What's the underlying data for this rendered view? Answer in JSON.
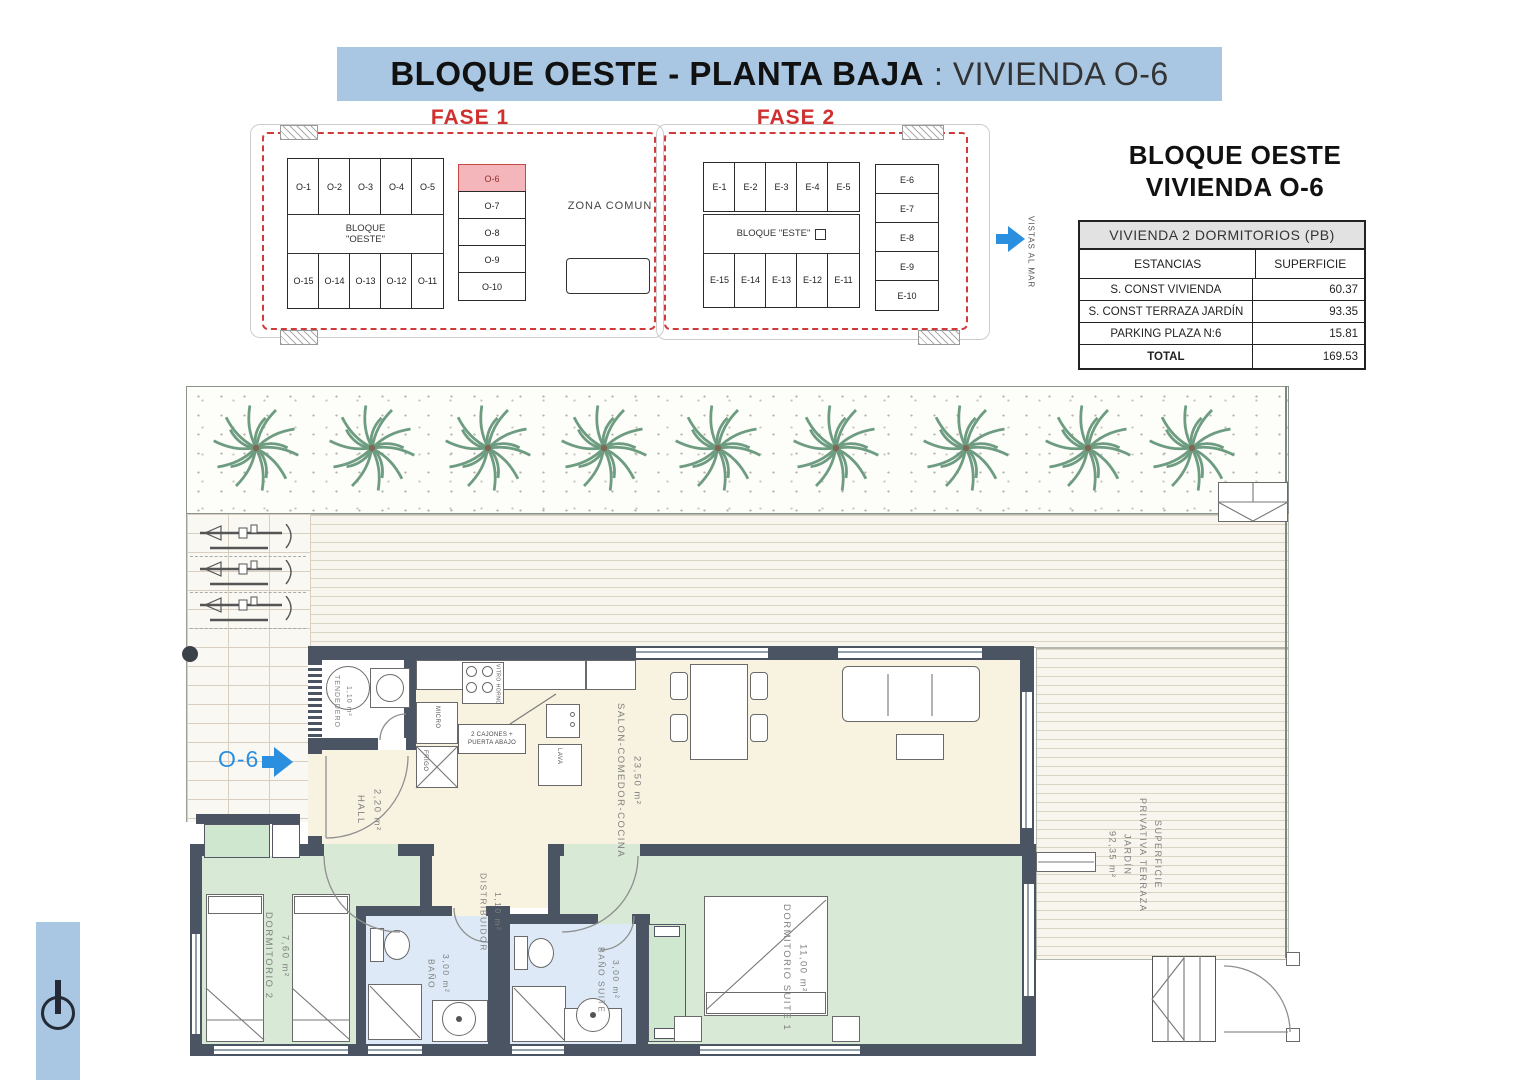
{
  "banner": {
    "title_bold": "BLOQUE OESTE - PLANTA BAJA",
    "title_rest": ": VIVIENDA O-6"
  },
  "site_plan": {
    "fase1": {
      "label": "FASE 1",
      "block_line1": "BLOQUE",
      "block_line2": "\"OESTE\"",
      "zona_comun": "ZONA COMUN",
      "top_units": [
        "O-1",
        "O-2",
        "O-3",
        "O-4",
        "O-5"
      ],
      "right_units": [
        "O-6",
        "O-7",
        "O-8",
        "O-9",
        "O-10"
      ],
      "bottom_units": [
        "O-15",
        "O-14",
        "O-13",
        "O-12",
        "O-11"
      ],
      "highlighted_unit": "O-6"
    },
    "fase2": {
      "label": "FASE 2",
      "block_label": "BLOQUE \"ESTE\"",
      "top_units": [
        "E-1",
        "E-2",
        "E-3",
        "E-4",
        "E-5"
      ],
      "right_units": [
        "E-6",
        "E-7",
        "E-8",
        "E-9",
        "E-10"
      ],
      "bottom_units": [
        "E-15",
        "E-14",
        "E-13",
        "E-12",
        "E-11"
      ]
    },
    "vistas_al_mar": "VISTAS AL MAR"
  },
  "info_panel": {
    "title_line1": "BLOQUE OESTE",
    "title_line2": "VIVIENDA O-6",
    "table": {
      "header": "VIVIENDA 2 DORMITORIOS (PB)",
      "col_estancias": "ESTANCIAS",
      "col_superficie": "SUPERFICIE",
      "rows": [
        {
          "estancia": "S. CONST VIVIENDA",
          "superficie": "60.37"
        },
        {
          "estancia": "S. CONST TERRAZA JARDÍN",
          "superficie": "93.35"
        },
        {
          "estancia": "PARKING   PLAZA   N:6",
          "superficie": "15.81"
        },
        {
          "estancia": "TOTAL",
          "superficie": "169.53"
        }
      ]
    }
  },
  "floor_plan": {
    "entry_label": "O-6",
    "rooms": {
      "tendedero": {
        "name": "TENDEDERO",
        "area": "1,10 m²"
      },
      "hall": {
        "name": "HALL",
        "area": "2,20 m²"
      },
      "salon": {
        "name": "SALON-COMEDOR-COCINA",
        "area": "23,50 m²"
      },
      "distribuidor": {
        "name": "DISTRIBUIDOR",
        "area": "1,10 m²"
      },
      "dormitorio2": {
        "name": "DORMITORIO 2",
        "area": "7,60 m²"
      },
      "bano": {
        "name": "BAÑO",
        "area": "3,00 m²"
      },
      "bano_suite": {
        "name": "BAÑO SUITE",
        "area": "3,00 m²"
      },
      "dormitorio_suite": {
        "name": "DORMITORIO SUITE 1",
        "area": "11,00 m²"
      }
    },
    "kitchen_labels": {
      "micro": "MICRO",
      "frigo": "FRIGO",
      "lava": "LAVA",
      "vitro": "VITRO",
      "horno": "HORNO",
      "cajones_line1": "2 CAJONES +",
      "cajones_line2": "PUERTA ABAJO"
    },
    "terrace_label": {
      "line1": "SUPERFICIE",
      "line2": "PRIVATIVA TERRAZA",
      "line3": "JARDÍN",
      "area": "92,35 m²"
    }
  },
  "colors": {
    "banner_blue": "#a9c6e2",
    "accent_blue": "#2b8fe0",
    "wall": "#4a5462",
    "red": "#cf3b3b",
    "room_cream": "#f8f3e1",
    "room_green": "#d8e9d6",
    "room_blue": "#dde9f6"
  }
}
